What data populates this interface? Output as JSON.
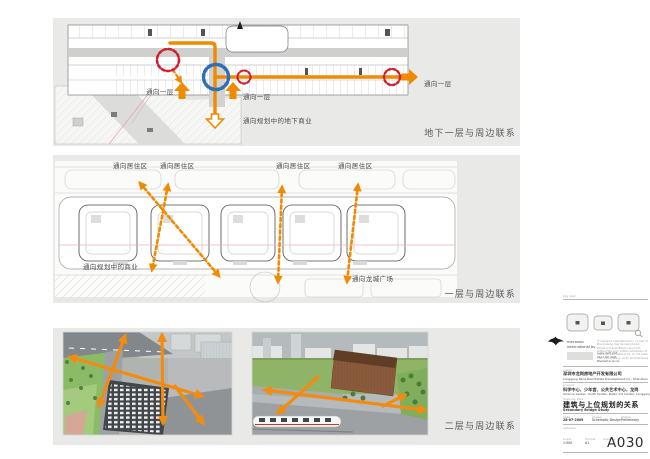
{
  "colors": {
    "accent_orange": "#F08A00",
    "circle_red": "#CE2030",
    "circle_blue": "#2E6FB7",
    "panel_bg": "#E9E9E8"
  },
  "panels": {
    "basement": {
      "caption": "地下一层与周边联系",
      "to_level1_a": "通向一层",
      "to_level1_b": "通向一层",
      "to_level1_c": "通向一层",
      "to_underground_retail": "通向规划中的地下商业"
    },
    "ground": {
      "caption": "一层与周边联系",
      "to_residential": [
        "通向居住区",
        "通向居住区",
        "通向居住区",
        "通向居住区"
      ],
      "to_planned_retail": "通向规划中的商业",
      "to_longcheng_square": "通向龙城广场"
    },
    "level2": {
      "caption": "二层与周边联系"
    }
  },
  "titleblock": {
    "keyplan_label": "key plan",
    "firm_line1": "mecanoo",
    "firm_line2": "international bv",
    "disclaimer": "© mecanoo international bv. no part of this drawing may be reproduced, stored or transmitted in any form without the prior written permission of mecanoo international bv. do not scale from this drawing. verify all dimensions on site.",
    "address_lines": [
      "oude delft 203",
      "2611 HD delft",
      "the netherlands"
    ],
    "client_label": "client",
    "client_cn": "深圳市龙岗房地产开发有限公司",
    "client_en": "Longgang Parie Real Estate Development Co., Shenzhen",
    "project_label": "project",
    "project_cn": "科学中心、少年宫、公共艺术中心，龙岗",
    "project_en": "Science Center, Youth Center, Public Art Center, Longgang",
    "title_label": "drawing title",
    "title_cn": "建筑与上位规划的关系",
    "title_en": "Secondary Bridge Study",
    "date_label": "date",
    "date_value": "28-07-2009",
    "phase_label": "phase",
    "phase_value": "Schematic Design",
    "status_label": "status",
    "status_value": "Preliminary",
    "remarks_label": "remarks",
    "scale_label": "scale",
    "scale_value": "1:500",
    "format_label": "format",
    "format_value": "A1",
    "number_label": "drawing no.",
    "number_value": "A030"
  }
}
